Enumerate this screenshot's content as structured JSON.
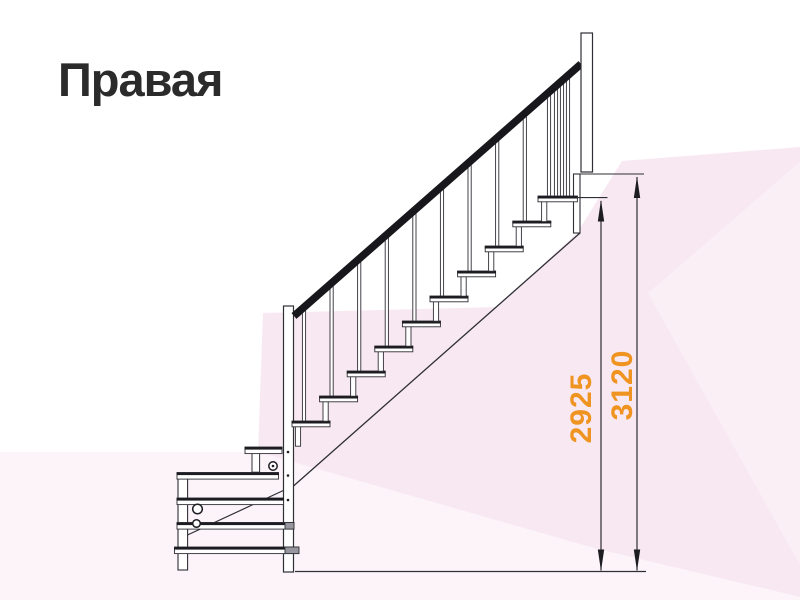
{
  "title": "Правая",
  "dimension_labels": {
    "inner": "2925",
    "outer": "3120"
  },
  "colors": {
    "dimension_label": "#EF9421",
    "title": "#2B2B2B",
    "line_art": "#2F2F36",
    "handrail": "#17171C",
    "background_pink": "#F8E8F2",
    "background_pink_light": "#FBEFF6",
    "background_pink_pale": "#FCF4F9"
  },
  "diagram": {
    "type": "staircase-side-elevation",
    "upper_flight_treads": 10,
    "winder_treads": 5,
    "has_handrail": true
  }
}
